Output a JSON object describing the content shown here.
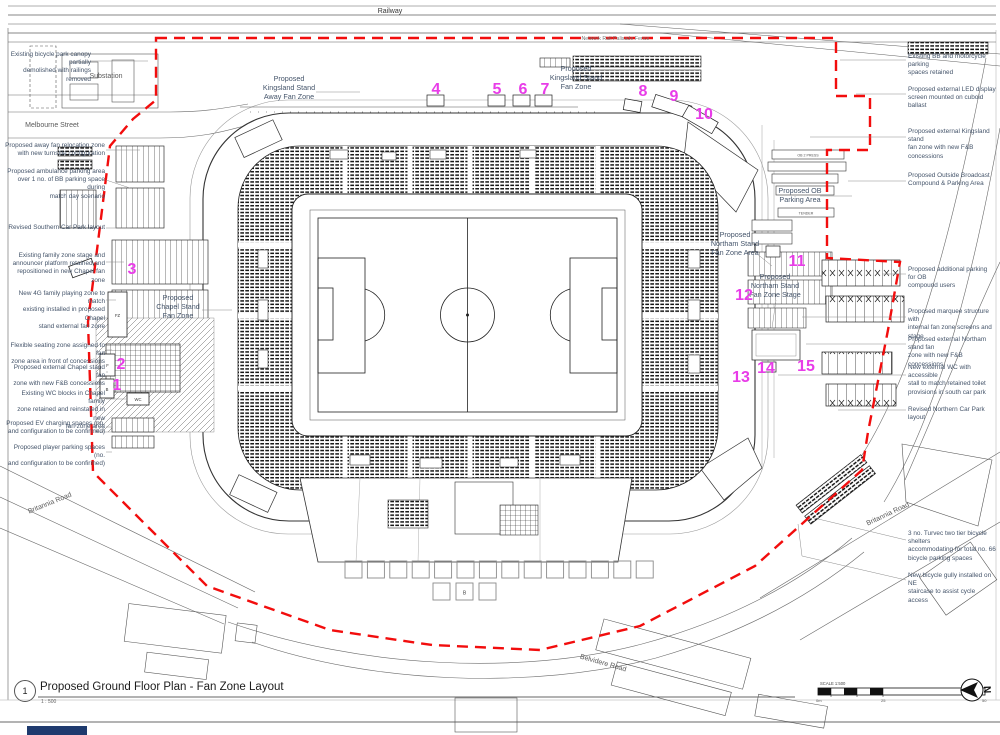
{
  "sheet": {
    "detail_number": "1",
    "title": "Proposed Ground Floor Plan - Fan Zone Layout",
    "scale": "1 : 500",
    "scale_bar_label": "SCALE 1:500",
    "scale_ticks": [
      "0m",
      "25",
      "50"
    ],
    "north_label": "N"
  },
  "context_labels": {
    "railway": "Railway",
    "palisade_fence": "Network Rail Palisade Fence",
    "substation": "Substation",
    "melbourne_street": "Melbourne Street",
    "britannia_road_sw": "Britannia Road",
    "britannia_road_e": "Britannia Road",
    "belvidere_road": "Belvidere Road"
  },
  "zone_labels": {
    "kingsland_away": "Proposed\nKingsland Stand\nAway Fan Zone",
    "kingsland": "Proposed\nKingsland Stand\nFan Zone",
    "ob_parking": "Proposed OB\nParking Area",
    "northam_area": "Proposed\nNortham Stand\nFan Zone Area",
    "northam_stage": "Proposed\nNortham Stand\nFan Zone Stage",
    "chapel": "Proposed\nChapel Stand\nFan Zone"
  },
  "plan_features": {
    "fz": "FZ",
    "wc": "WC",
    "f": "F",
    "b": "B",
    "b_square": "B",
    "ob_box_1": "OB 2 PRESS",
    "ob_box_2": "TENDER"
  },
  "markers": [
    "1",
    "2",
    "3",
    "4",
    "5",
    "6",
    "7",
    "8",
    "9",
    "10",
    "11",
    "12",
    "13",
    "14",
    "15"
  ],
  "annotations_left": [
    "Existing bicycle park canopy partially\ndemolished with railings removed",
    "Proposed away fan relocation zone\nwith new turnstile configuration",
    "Proposed ambulance parking area\nover 1 no. of BB parking space during\nmatch day scenario",
    "Revised Southern Car Park layout",
    "Existing family zone stage and\nannouncer platform retained and\nrepositioned in new Chapel fan zone",
    "New 4G family playing zone to match\nexisting installed in proposed Chapel\nstand external fan zone",
    "Flexible seating zone assigned to fan\nzone area in front of concessions",
    "Proposed external Chapel stand fan\nzone with new F&B concessions",
    "Existing WC blocks in Chapel family\nzone retained and reinstated in new\nfan zone area",
    "Proposed EV charging spaces (no.\nand configuration to be confirmed)",
    "Proposed player parking spaces (no.\nand configuration to be confirmed)"
  ],
  "annotations_right": [
    "Existing BB and motorcycle parking\nspaces retained",
    "Proposed external LED display\nscreen mounted on cuboid ballast",
    "Proposed external Kingsland stand\nfan zone with new F&B concessions",
    "Proposed Outside Broadcast\nCompound & Parking Area",
    "Proposed additional parking for OB\ncompound users",
    "Proposed marquee structure with\ninternal fan zone screens and stage",
    "Proposed external Northam stand fan\nzone with new F&B concessions",
    "New external WC with accessible\nstall to match retained toilet\nprovisions in south car park",
    "Revised Northern Car Park layout",
    "3 no. Turvec two tier bicycle shelters\naccommodating for total no. 66\nbicycle parking spaces",
    "New bicycle gully installed on NE\nstaircase to assist cycle access"
  ]
}
